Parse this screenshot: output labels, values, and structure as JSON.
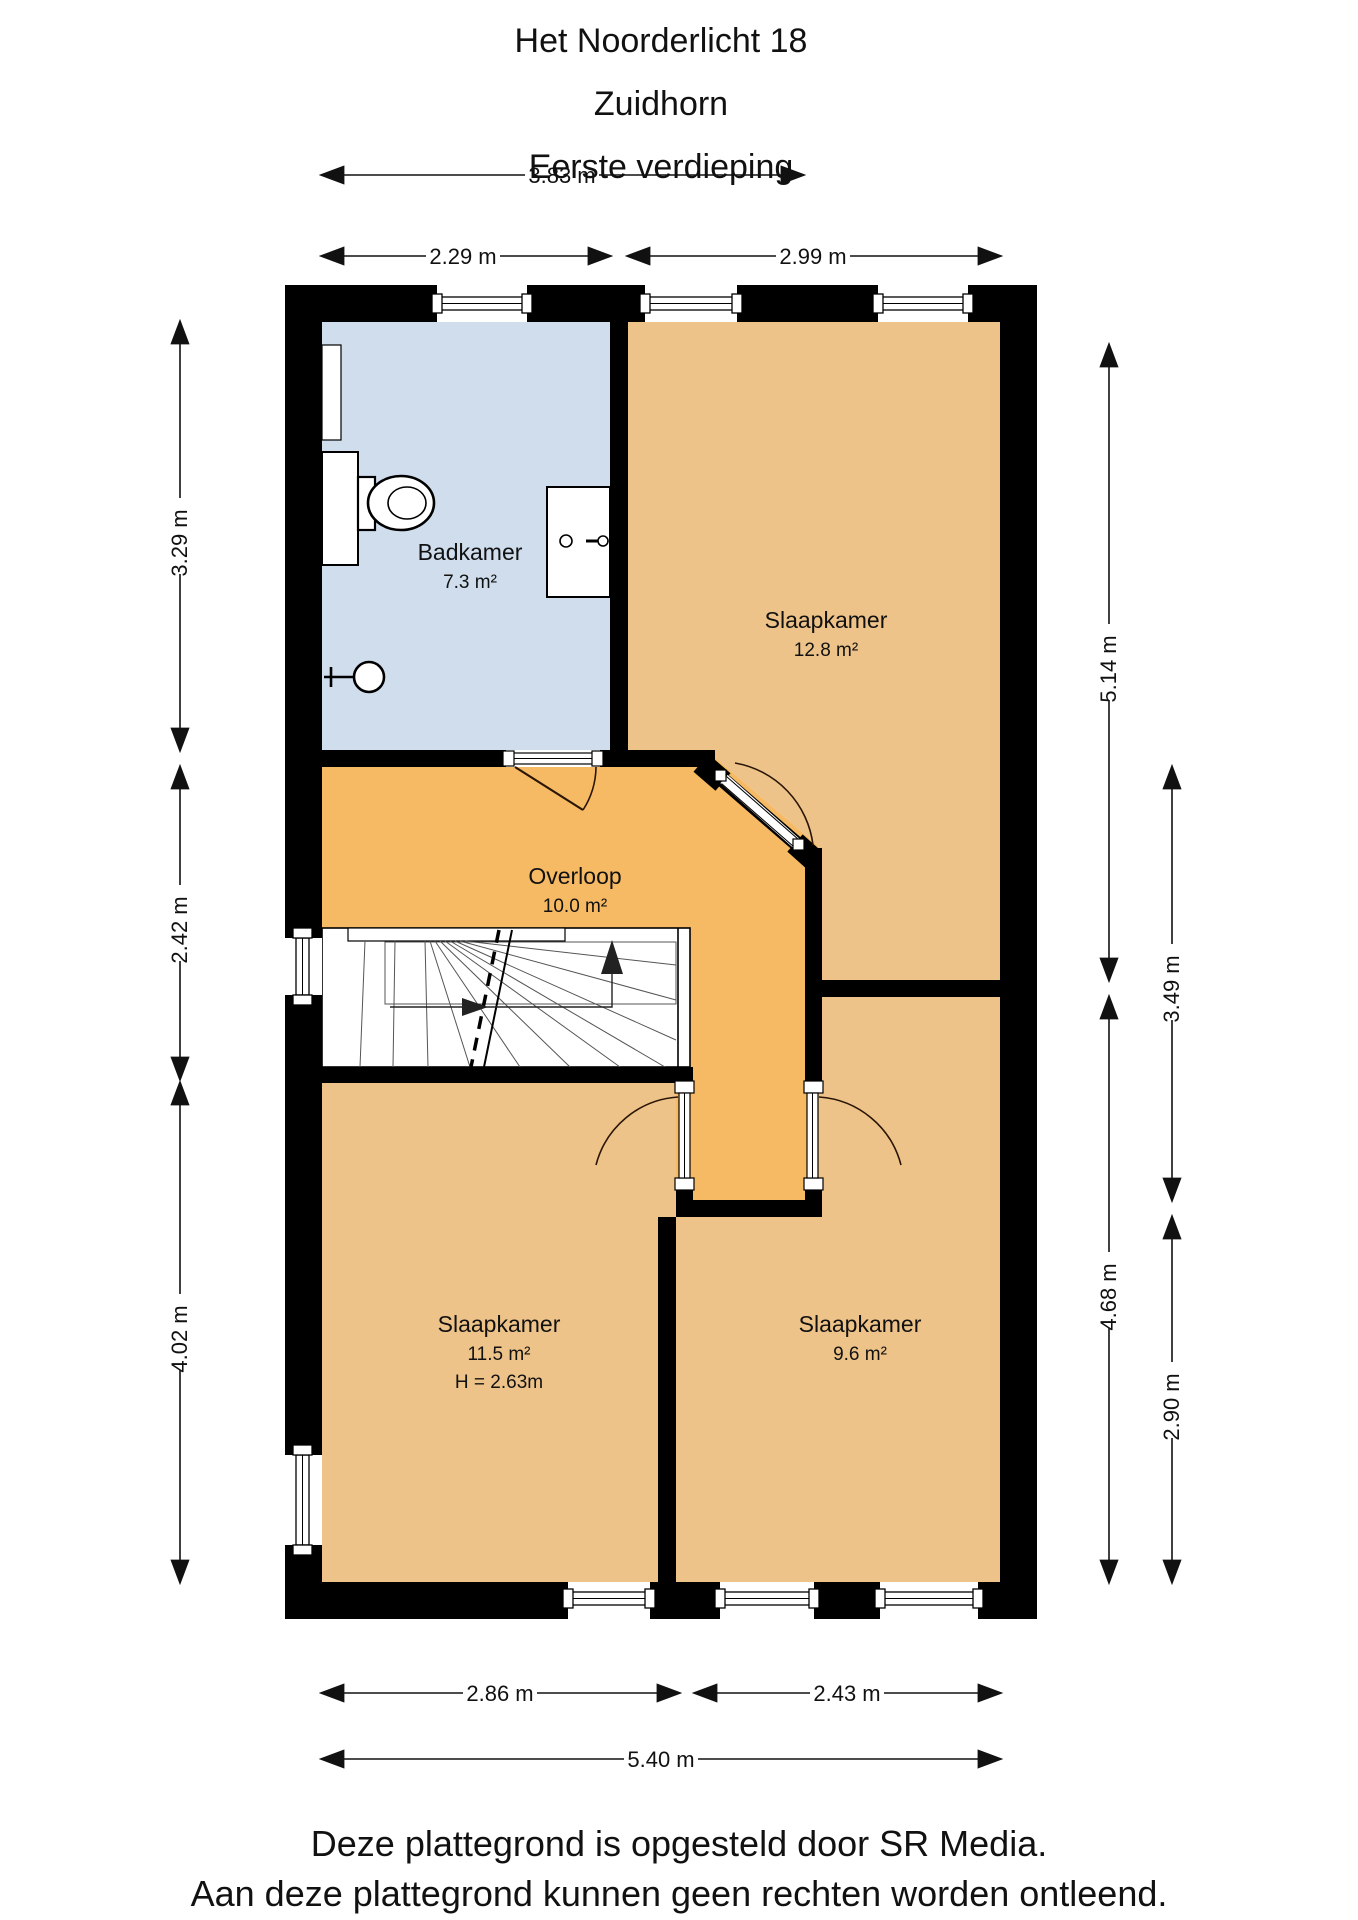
{
  "title": {
    "line1": "Het Noorderlicht 18",
    "line2": "Zuidhorn",
    "line3": "Eerste verdieping"
  },
  "rooms": {
    "badkamer": {
      "name": "Badkamer",
      "area": "7.3 m²"
    },
    "slaapkamer_12": {
      "name": "Slaapkamer",
      "area": "12.8 m²"
    },
    "overloop": {
      "name": "Overloop",
      "area": "10.0 m²"
    },
    "slaapkamer_11": {
      "name": "Slaapkamer",
      "area": "11.5 m²",
      "ceiling_height": "H = 2.63m"
    },
    "slaapkamer_9": {
      "name": "Slaapkamer",
      "area": "9.6 m²"
    }
  },
  "dimensions": {
    "top_total": "3.83 m",
    "top_left": "2.29 m",
    "top_right": "2.99 m",
    "left_top": "3.29 m",
    "left_middle": "2.42 m",
    "left_bottom": "4.02 m",
    "right_inner_top": "5.14 m",
    "right_inner_bottom": "4.68 m",
    "right_outer_top": "3.49 m",
    "right_outer_bottom": "2.90 m",
    "bottom_left": "2.86 m",
    "bottom_right": "2.43 m",
    "bottom_total": "5.40 m"
  },
  "footer": {
    "line1": "Deze plattegrond is opgesteld door SR Media.",
    "line2": "Aan deze plattegrond kunnen geen rechten worden ontleend."
  },
  "colors": {
    "wall": "#000000",
    "bathroom": "#cfdded",
    "bedroom": "#eec389",
    "hallway": "#f7ba64"
  }
}
